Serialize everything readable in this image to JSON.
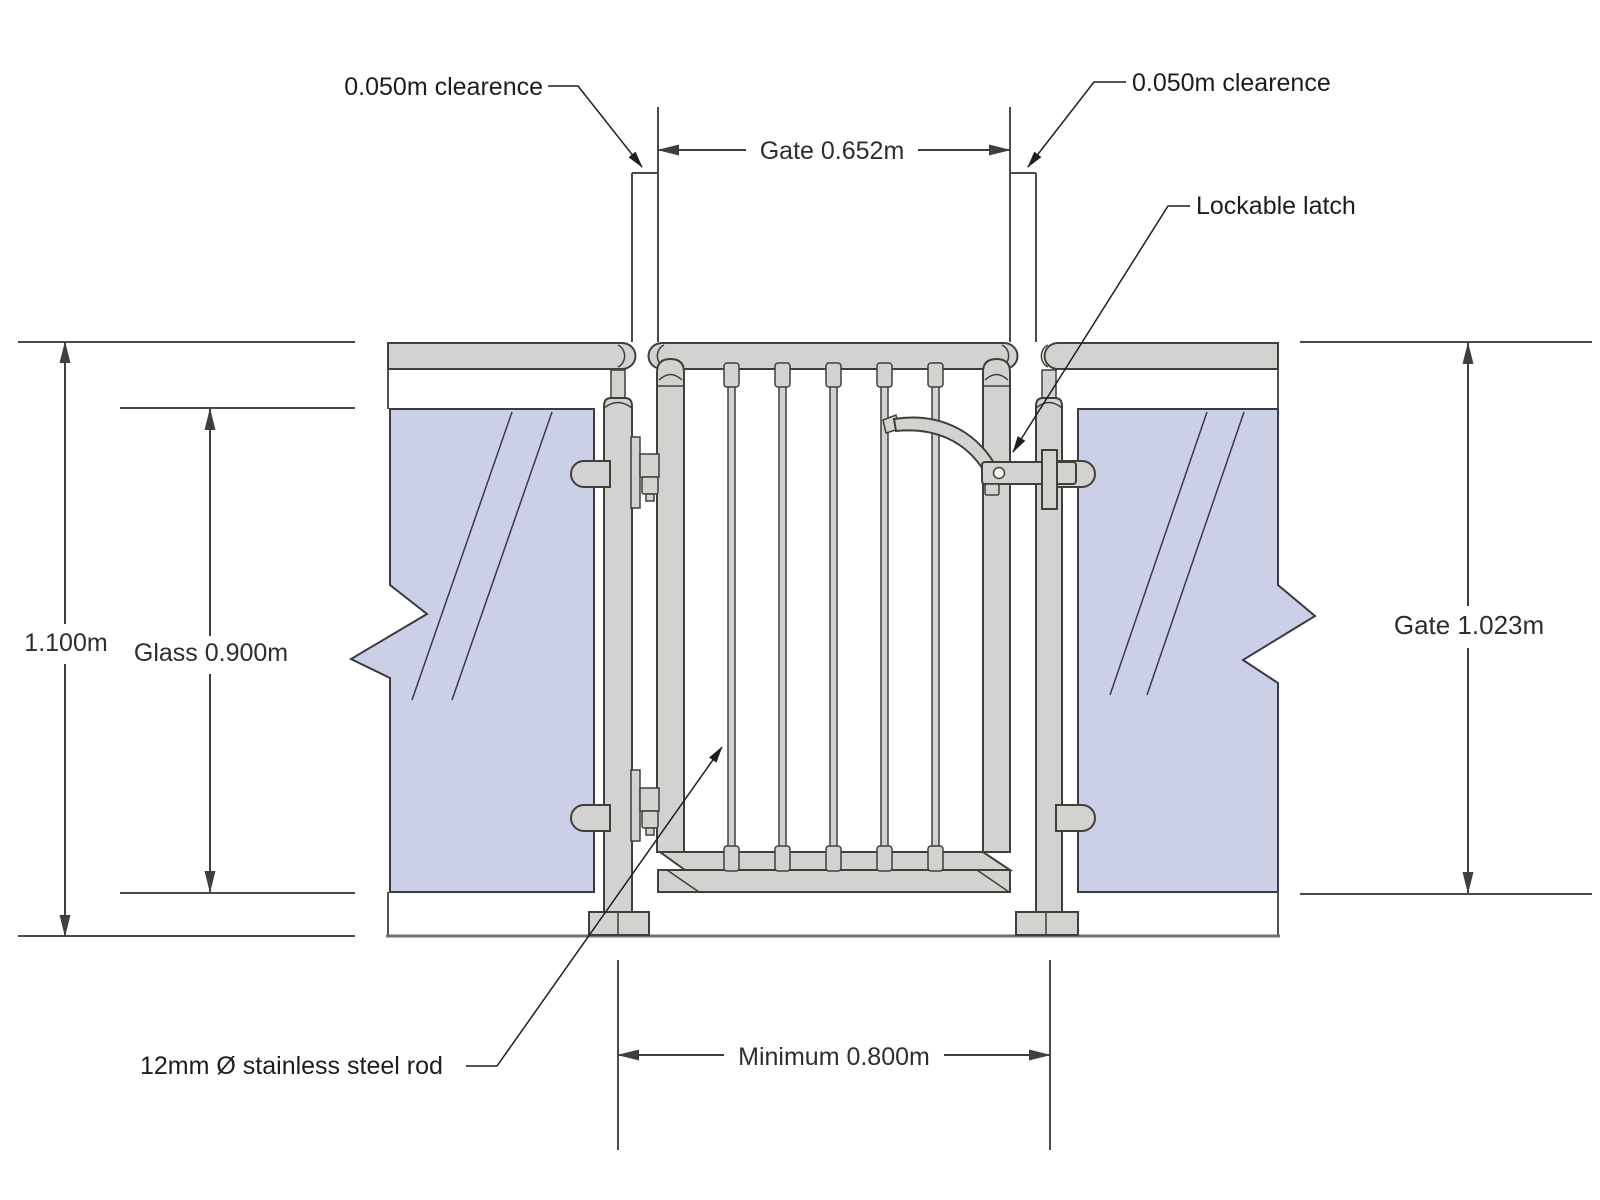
{
  "annotations": {
    "clearance_left": "0.050m clearence",
    "clearance_right": "0.050m clearence",
    "lockable_latch": "Lockable latch",
    "stainless_rod": "12mm Ø stainless steel rod"
  },
  "dimensions": {
    "gate_width": "Gate 0.652m",
    "total_height": "1.100m",
    "glass_height": "Glass 0.900m",
    "gate_height": "Gate 1.023m",
    "minimum_opening": "Minimum 0.800m"
  },
  "values": {
    "clearance_m": 0.05,
    "gate_width_m": 0.652,
    "total_height_m": 1.1,
    "glass_height_m": 0.9,
    "gate_height_m": 1.023,
    "minimum_opening_m": 0.8,
    "rod_diameter_mm": 12,
    "gate_rod_count": 5
  },
  "colors": {
    "metal": "#d2d2d0",
    "glass": "#ccd0e7",
    "outline": "#413f3a",
    "dimension_lines": "#3f3f3f",
    "extension_lines": "#4a4a4a",
    "text": "#1d1d1d",
    "background": "#ffffff"
  }
}
